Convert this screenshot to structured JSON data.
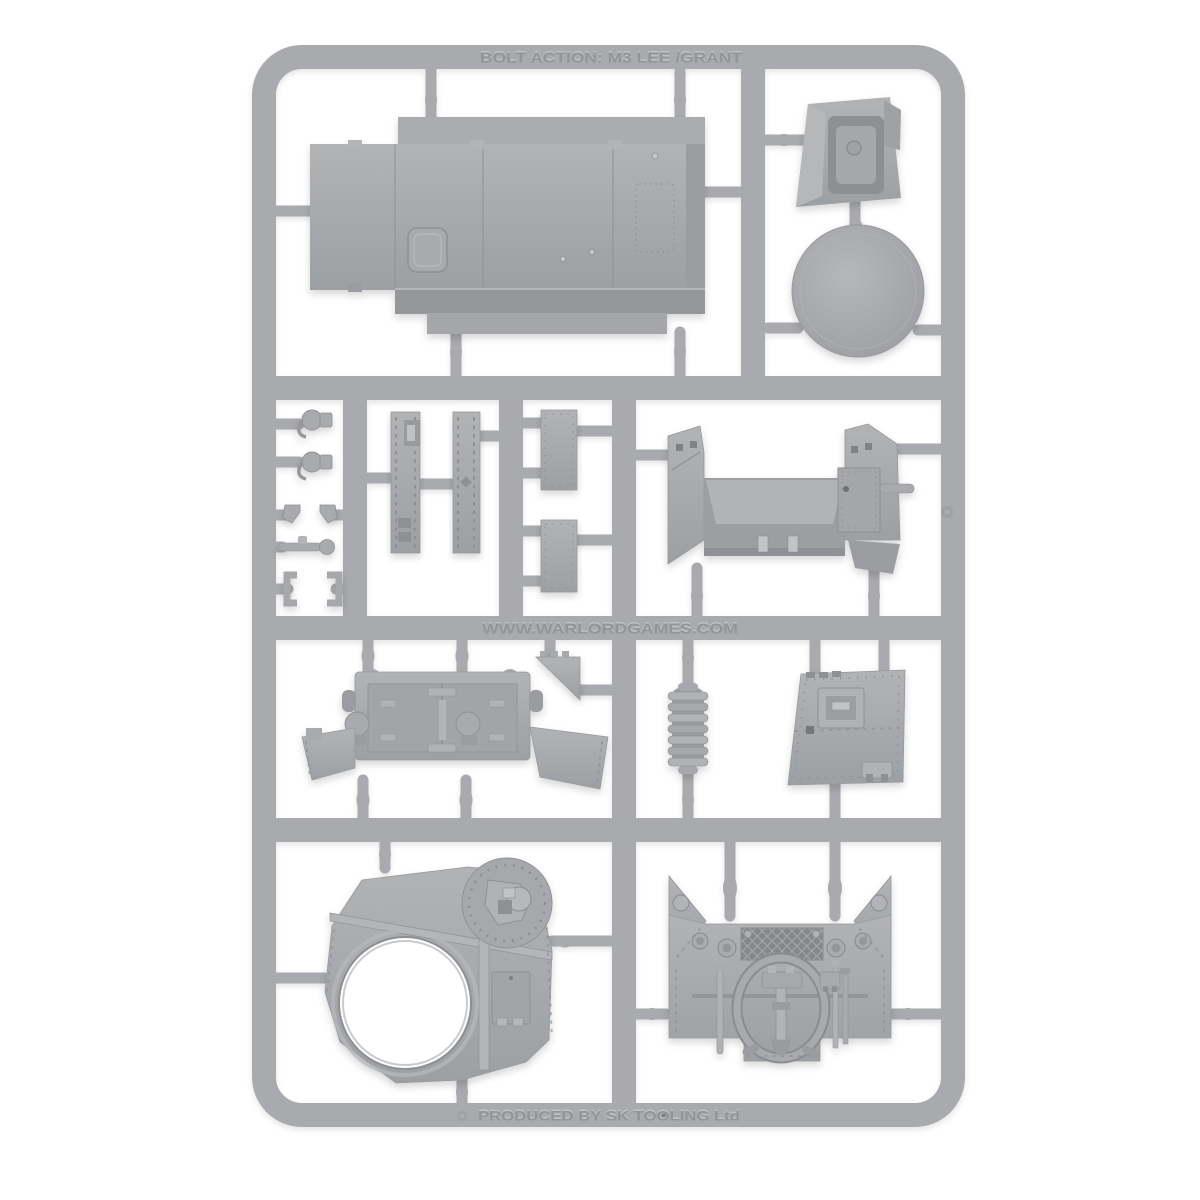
{
  "photo": {
    "subject": "grey plastic model kit sprue on white background",
    "kit_name": "Bolt Action M3 Lee / Grant",
    "background_color": "#ffffff"
  },
  "sprue": {
    "plastic_color": "#a8aaad",
    "plastic_shadow_color": "#8e9093",
    "plastic_highlight_color": "#c6c8ca",
    "embossed_text": {
      "top": "BOLT ACTION: M3 LEE /GRANT",
      "middle": "WWW.WARLORDGAMES.COM",
      "bottom": "PRODUCED BY SK TOOLING Ltd"
    },
    "parts": [
      "upper-hull-deck",
      "drivers-hood",
      "turret-ring-cover-disc",
      "periscope-a",
      "periscope-b",
      "vision-port-bracket-a",
      "vision-port-bracket-b",
      "towing-shackle-rod",
      "door-bracket-a",
      "door-bracket-b",
      "side-skirt-strip-a",
      "side-skirt-strip-b",
      "stowage-plate-a",
      "stowage-plate-b",
      "sponson-front-assembly",
      "lower-rear-plate-with-doors",
      "fender-triangle",
      "air-filter-cylinder",
      "riveted-side-hatch-plate",
      "turret-roof-with-ring-opening",
      "engine-rear-plate-with-grille-and-tow-cable"
    ]
  }
}
